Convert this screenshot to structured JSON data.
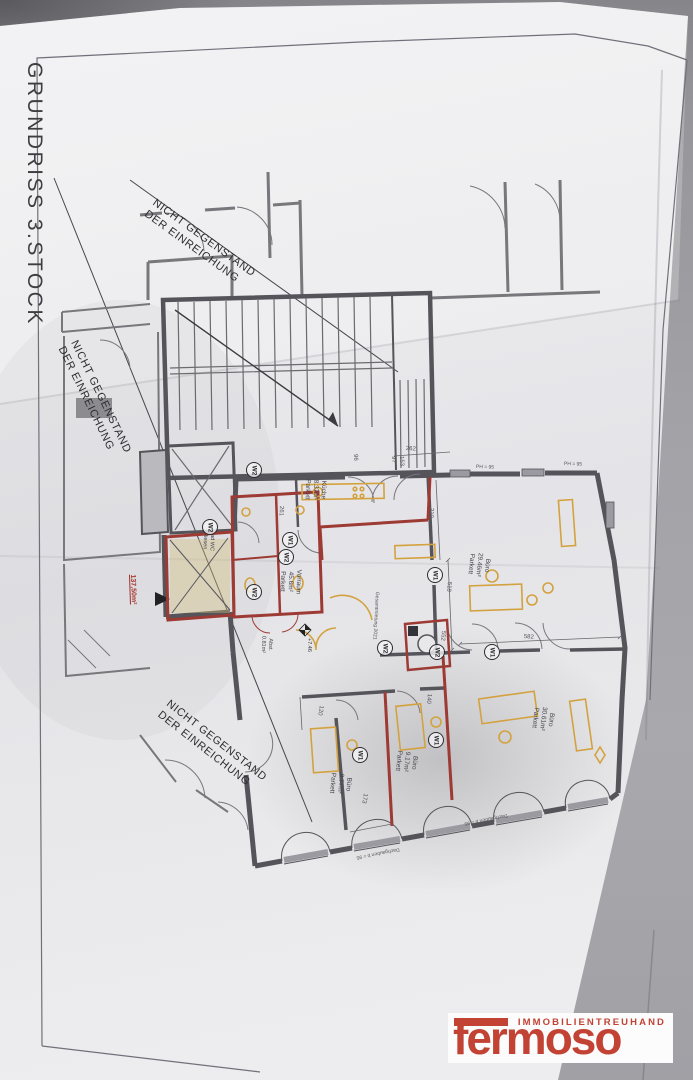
{
  "title": "GRUNDRISS 3.STOCK",
  "annotations": {
    "line1": "NICHT GEGENSTAND",
    "line2": "DER EINREICHUNG"
  },
  "plan": {
    "rooms": [
      {
        "name": "Küche",
        "area": "8.37m²",
        "floor": "Parkett"
      },
      {
        "name": "Vorraum",
        "area": "45.6m²",
        "floor": "Parkett"
      },
      {
        "name": "Büro",
        "area": "29.46m²",
        "floor": "Parkett"
      },
      {
        "name": "Büro",
        "area": "30.61m²",
        "floor": "Parkett"
      },
      {
        "name": "Büro",
        "area": "9.17m²",
        "floor": "Parkett"
      },
      {
        "name": "Büro",
        "area": "9.77m²",
        "floor": "Parkett"
      },
      {
        "name": "Bad WC",
        "area": "",
        "floor": "Fliesen"
      },
      {
        "name": "Abst.",
        "area": "0.81m²",
        "floor": ""
      }
    ],
    "total_area": "137,50m²",
    "level_marker": "+7.46",
    "markers": [
      {
        "label": "W2"
      },
      {
        "label": "W2"
      },
      {
        "label": "W1"
      },
      {
        "label": "W2"
      },
      {
        "label": "W2"
      },
      {
        "label": "W1"
      },
      {
        "label": "W2"
      },
      {
        "label": "W2"
      },
      {
        "label": "W1"
      },
      {
        "label": "W1"
      },
      {
        "label": "W1"
      }
    ],
    "dimensions": [
      "210",
      "261",
      "262",
      "518",
      "552",
      "582",
      "97",
      "153",
      "96",
      "140",
      "120",
      "173",
      "PH = 95",
      "Gesamtmietung 2021",
      "Dachgauben b = 95"
    ]
  },
  "logo": {
    "tagline": "IMMOBILIENTREUHAND",
    "brand": "fermoso",
    "brand_color": "#c24334"
  },
  "colors": {
    "paper": "#eaeaec",
    "table": "#a3a3a7",
    "wall": "#54545a",
    "red_wall": "#9d3a34",
    "furniture_yellow": "#d3a23f"
  }
}
